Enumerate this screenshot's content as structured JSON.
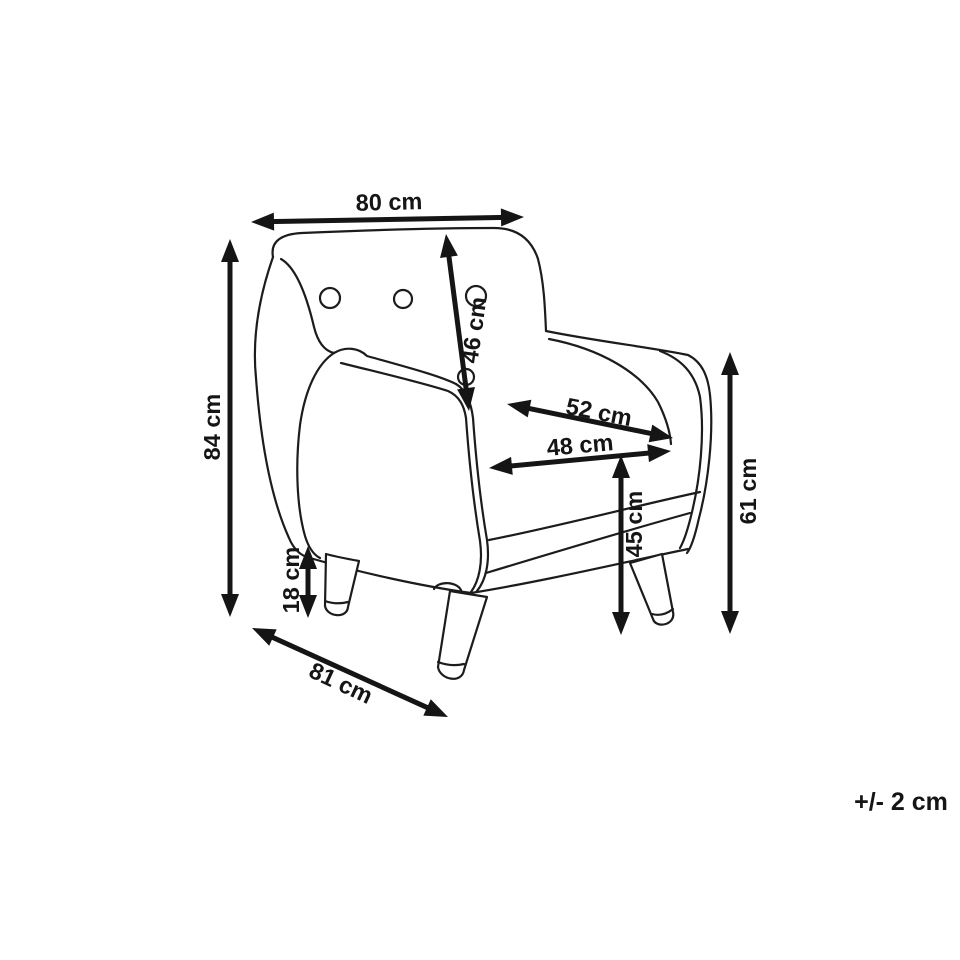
{
  "diagram": {
    "type": "dimension-drawing",
    "subject": "armchair",
    "unit": "cm",
    "tolerance_note": "+/- 2 cm",
    "colors": {
      "line": "#1c1c1c",
      "arrow": "#151515",
      "background": "#ffffff"
    },
    "dimensions": [
      {
        "id": "overall-width",
        "label": "80 cm",
        "value_cm": 80,
        "arrow": {
          "x1": 251,
          "y1": 222,
          "x2": 524,
          "y2": 217
        },
        "label_pos": {
          "x": 389,
          "y": 202,
          "rotate": -1.5
        }
      },
      {
        "id": "backrest-height",
        "label": "46 cm",
        "value_cm": 46,
        "arrow": {
          "x1": 446,
          "y1": 234,
          "x2": 469,
          "y2": 411
        },
        "label_pos": {
          "x": 474,
          "y": 330,
          "rotate": -82
        }
      },
      {
        "id": "overall-height",
        "label": "84 cm",
        "value_cm": 84,
        "arrow": {
          "x1": 230,
          "y1": 239,
          "x2": 230,
          "y2": 617
        },
        "label_pos": {
          "x": 212,
          "y": 427,
          "rotate": -90
        }
      },
      {
        "id": "seat-back-width",
        "label": "52 cm",
        "value_cm": 52,
        "arrow": {
          "x1": 507,
          "y1": 404,
          "x2": 673,
          "y2": 438
        },
        "label_pos": {
          "x": 599,
          "y": 412,
          "rotate": 11
        }
      },
      {
        "id": "seat-width",
        "label": "48 cm",
        "value_cm": 48,
        "arrow": {
          "x1": 489,
          "y1": 468,
          "x2": 671,
          "y2": 451
        },
        "label_pos": {
          "x": 580,
          "y": 445,
          "rotate": -5
        }
      },
      {
        "id": "seat-height",
        "label": "45 cm",
        "value_cm": 45,
        "arrow": {
          "x1": 621,
          "y1": 455,
          "x2": 621,
          "y2": 635
        },
        "label_pos": {
          "x": 634,
          "y": 524,
          "rotate": -90
        }
      },
      {
        "id": "side-height",
        "label": "61 cm",
        "value_cm": 61,
        "arrow": {
          "x1": 730,
          "y1": 352,
          "x2": 730,
          "y2": 634
        },
        "label_pos": {
          "x": 748,
          "y": 491,
          "rotate": -90
        }
      },
      {
        "id": "leg-height",
        "label": "18 cm",
        "value_cm": 18,
        "arrow": {
          "x1": 308,
          "y1": 546,
          "x2": 308,
          "y2": 618
        },
        "label_pos": {
          "x": 291,
          "y": 580,
          "rotate": -90
        }
      },
      {
        "id": "overall-depth",
        "label": "81 cm",
        "value_cm": 81,
        "arrow": {
          "x1": 252,
          "y1": 628,
          "x2": 448,
          "y2": 717
        },
        "label_pos": {
          "x": 341,
          "y": 683,
          "rotate": 25
        }
      }
    ]
  }
}
